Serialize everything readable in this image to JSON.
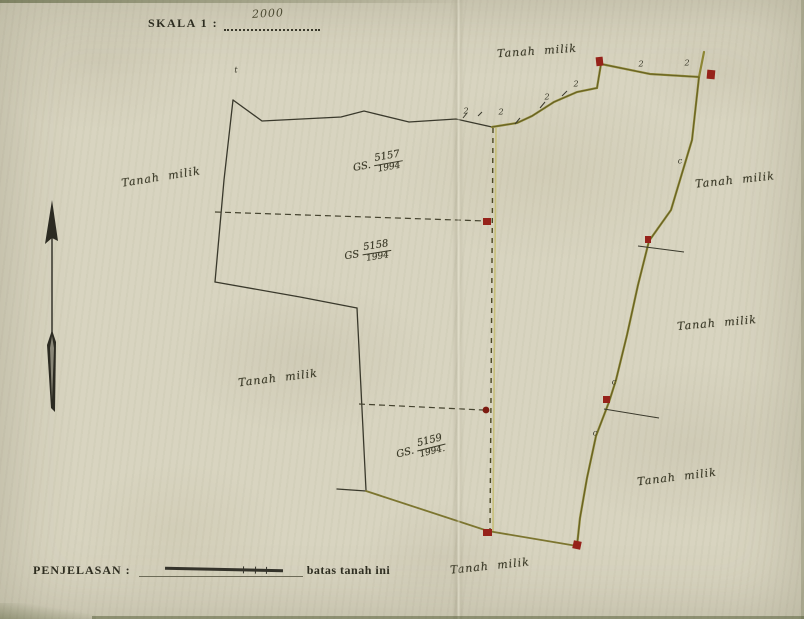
{
  "scale": {
    "label": "SKALA 1 :",
    "value": "2000"
  },
  "legend": {
    "title": "PENJELASAN :",
    "boundary_label": "batas tanah ini"
  },
  "map": {
    "owner_labels": [
      {
        "text": "Tanah milik"
      },
      {
        "text": "Tanah milik"
      },
      {
        "text": "Tanah milik"
      },
      {
        "text": "Tanah milik"
      },
      {
        "text": "Tanah milik"
      },
      {
        "text": "Tanah milik"
      },
      {
        "text": "Tanah milik"
      }
    ],
    "parcel_labels": [
      {
        "prefix": "GS.",
        "number": "5157",
        "year": "1994"
      },
      {
        "prefix": "GS",
        "number": "5158",
        "year": "1994"
      },
      {
        "prefix": "GS.",
        "number": "5159",
        "year": "1994."
      }
    ],
    "point_labels": [
      {
        "text": "t"
      },
      {
        "text": "2"
      },
      {
        "text": "2"
      },
      {
        "text": "2"
      },
      {
        "text": "2"
      },
      {
        "text": "2"
      },
      {
        "text": "2"
      },
      {
        "text": "c"
      },
      {
        "text": "c"
      },
      {
        "text": "c"
      }
    ],
    "colors": {
      "boundary_dark": "#3a392c",
      "boundary_olive": "#8d8634",
      "dash_dark": "#4b4724",
      "marker_red": "#96221a"
    }
  }
}
